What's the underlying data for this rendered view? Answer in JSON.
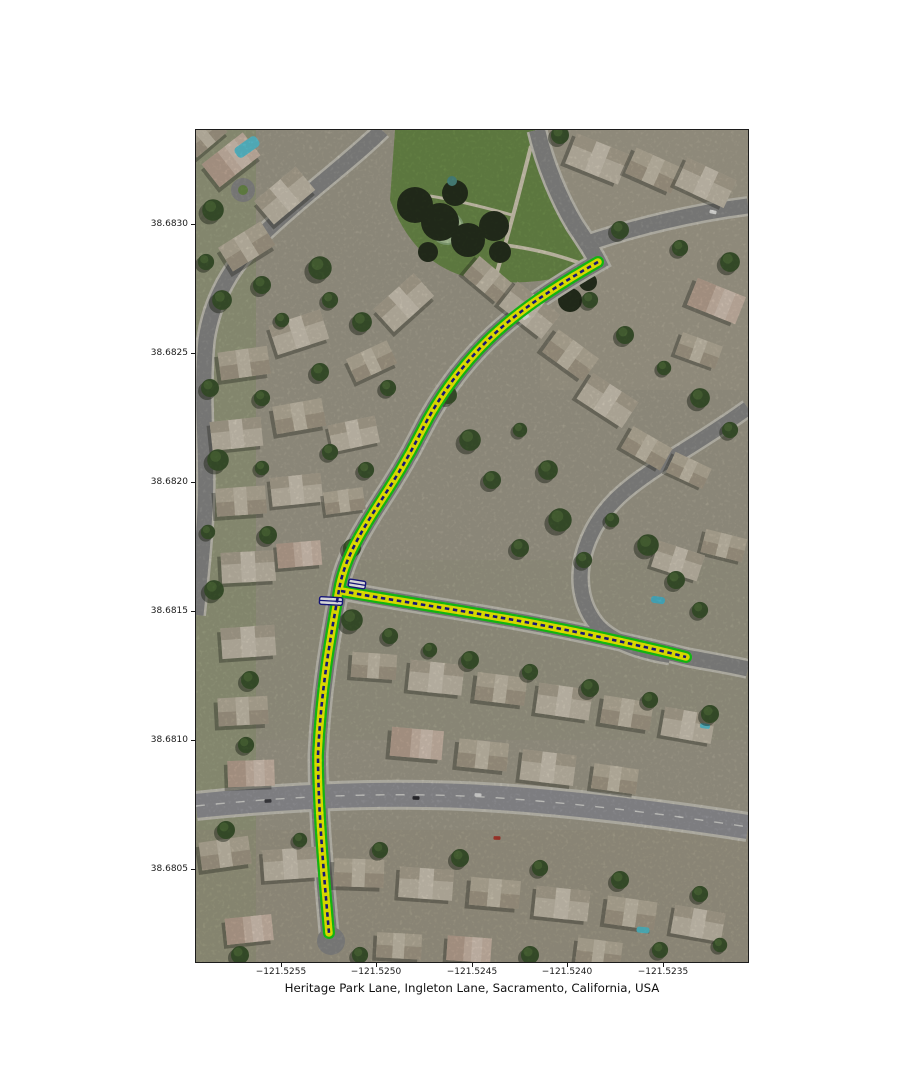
{
  "figure": {
    "title": "Heritage Park Lane, Ingleton Lane, Sacramento, California, USA",
    "background_color": "#ffffff",
    "map_kind": "aerial imagery of residential neighborhood with highlighted streets"
  },
  "axes": {
    "x_ticks": [
      "−121.5255",
      "−121.5250",
      "−121.5245",
      "−121.5240",
      "−121.5235"
    ],
    "y_ticks": [
      "38.6830",
      "38.6825",
      "38.6820",
      "38.6815",
      "38.6810",
      "38.6805"
    ]
  },
  "routes": {
    "streets": [
      "Heritage Park Lane",
      "Ingleton Lane"
    ],
    "place": "Sacramento, California, USA",
    "style": {
      "outline_color": "#17d517",
      "fill_color": "#ffff00",
      "centerline_color": "#1b1b8f",
      "centerline_style": "dashed",
      "junction_marker": "white bar with navy border"
    }
  }
}
